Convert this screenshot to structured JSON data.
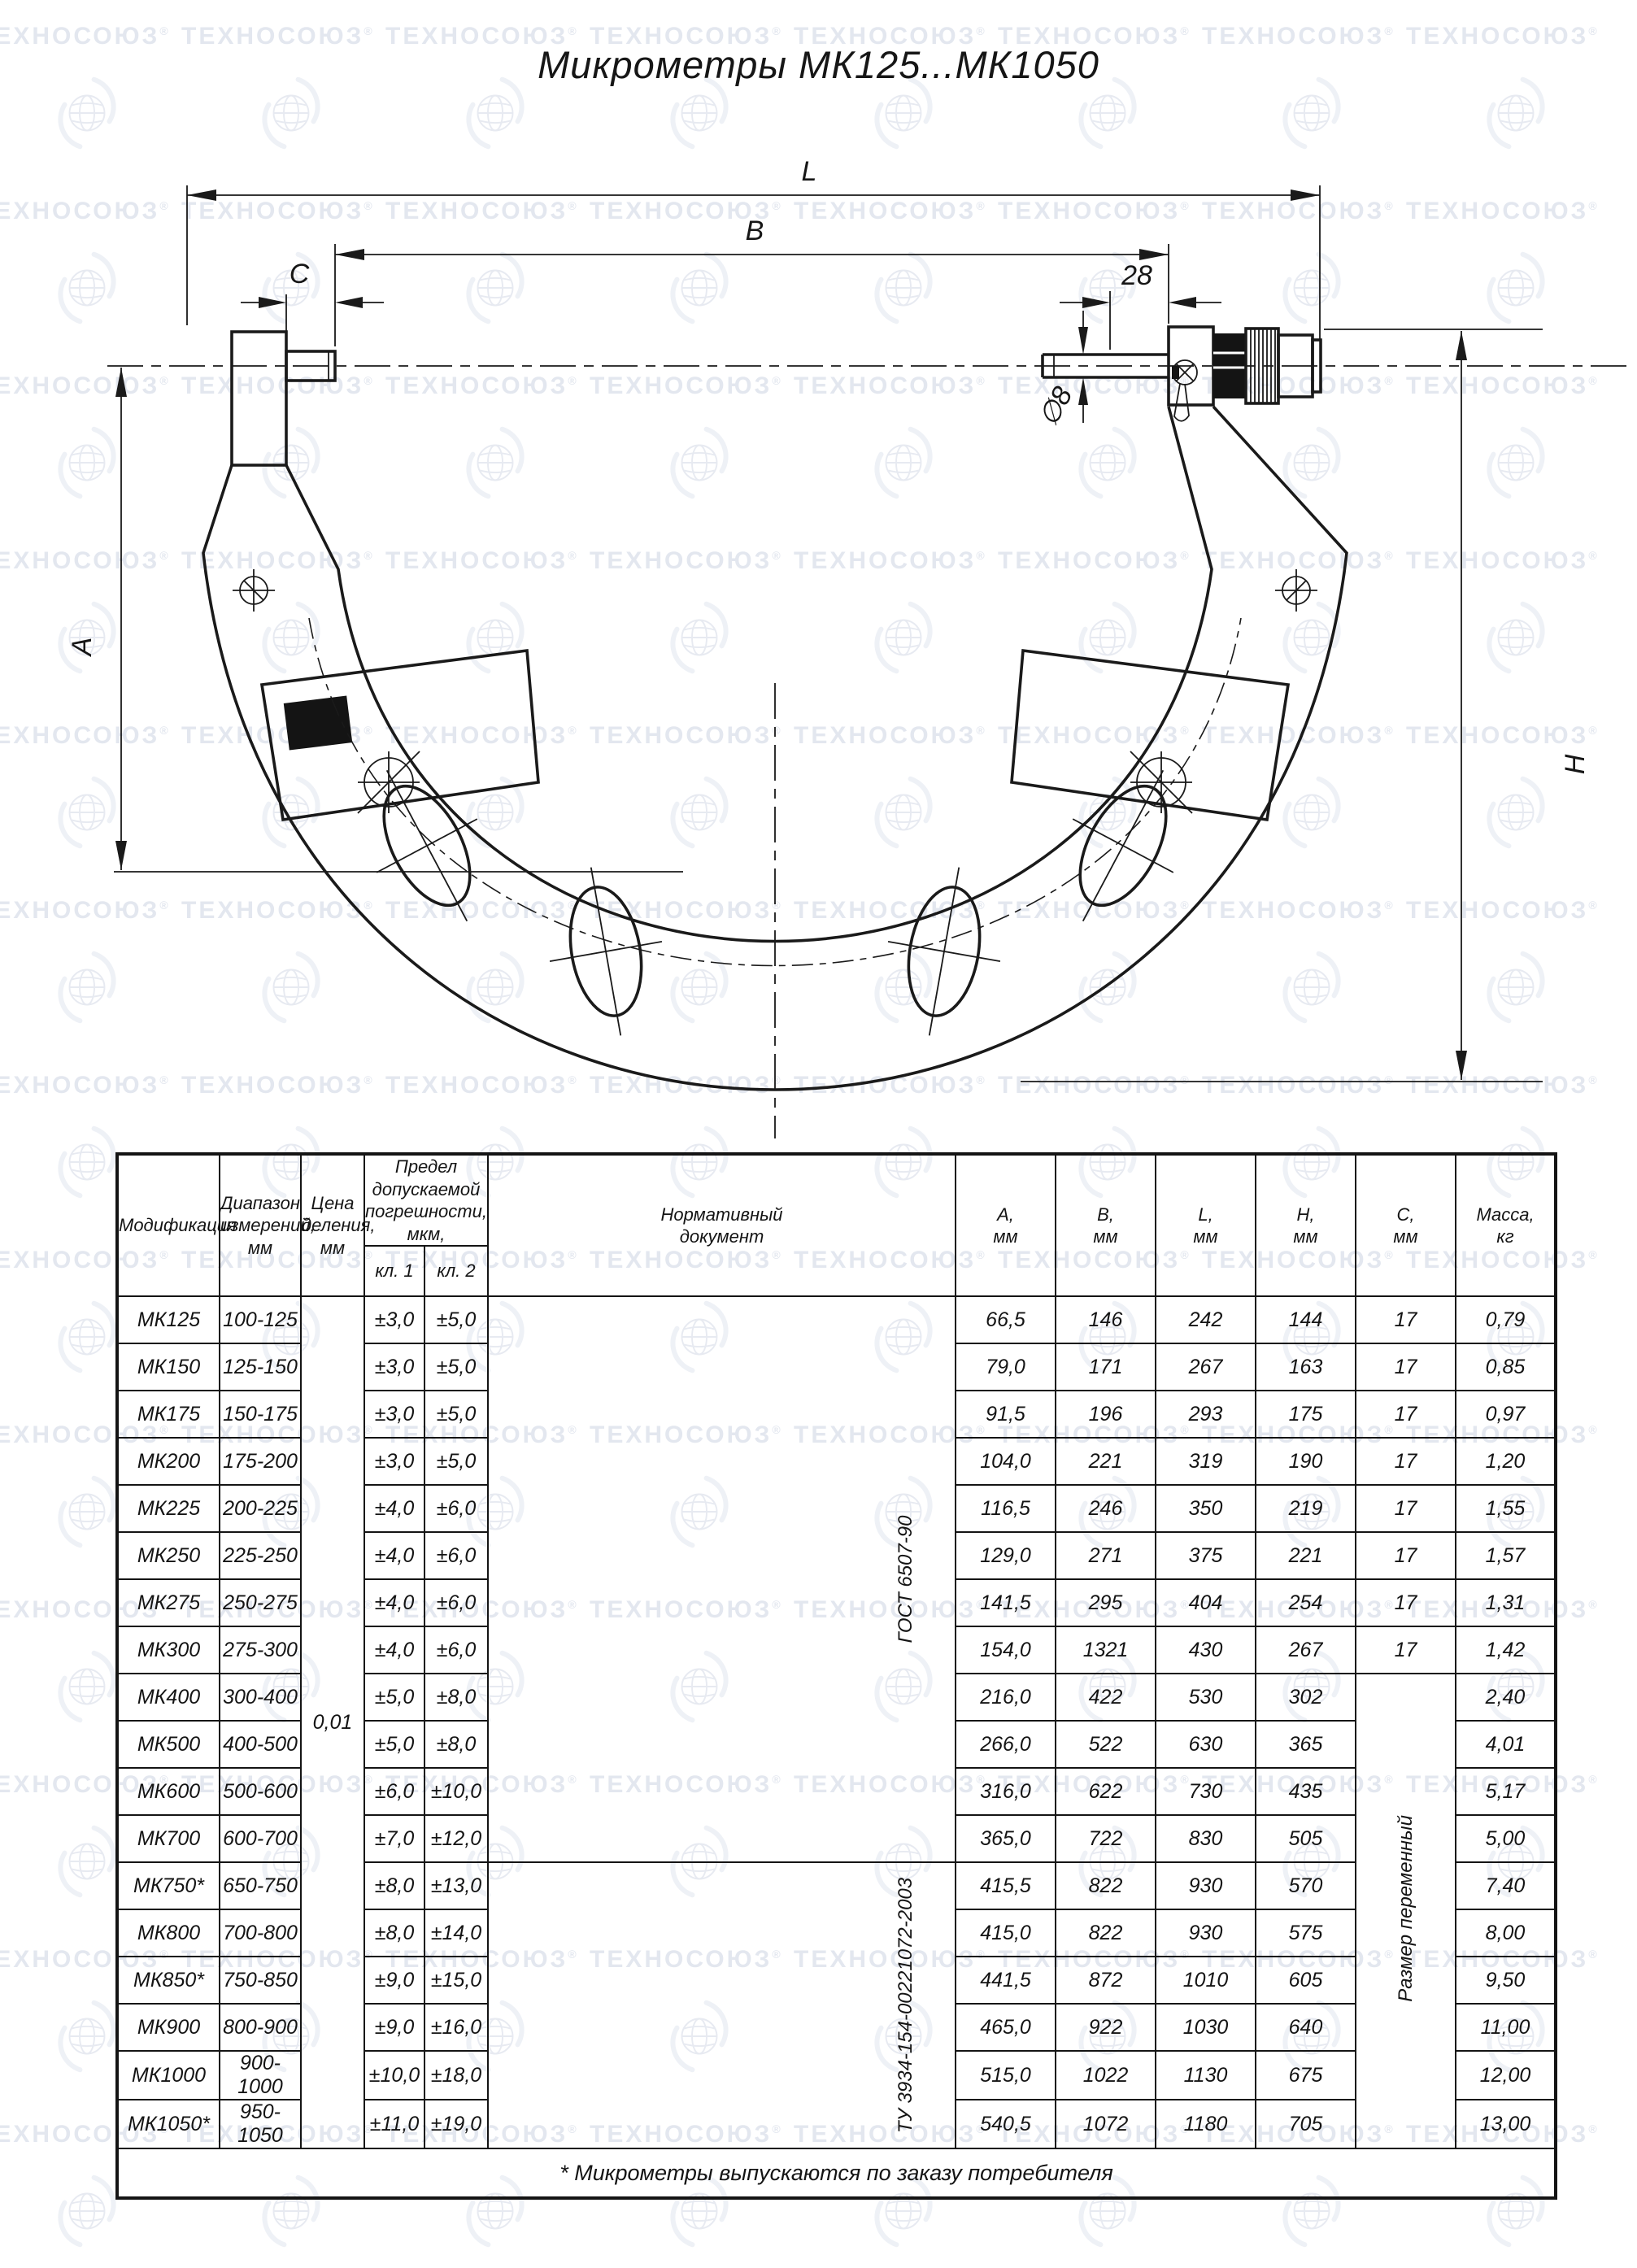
{
  "watermark": {
    "text": "ТЕХНОСОЮЗ",
    "reg": "®"
  },
  "title": "Микрометры МК125...МК1050",
  "drawing": {
    "dims": {
      "L": "L",
      "B": "B",
      "C": "C",
      "spindle_len": "28",
      "A": "A",
      "H": "H",
      "spindle_dia": "∅8"
    }
  },
  "table": {
    "headers": {
      "modification": "Модификация",
      "range": "Диапазон\nизмерений,\nмм",
      "division": "Цена\nделения,\nмм",
      "error_limit": "Предел допускаемой\nпогрешности, мкм,",
      "cl1": "кл. 1",
      "cl2": "кл. 2",
      "norm_doc": "Нормативный\nдокумент",
      "a": "А,\nмм",
      "b": "В,\nмм",
      "l": "L,\nмм",
      "h": "Н,\nмм",
      "c": "С,\nмм",
      "mass": "Масса,\nкг"
    },
    "merged": {
      "division_value": "0,01",
      "gost": "ГОСТ 6507-90",
      "tu": "ТУ 3934-154-00221072-2003",
      "c_note": "Размер переменный"
    },
    "rows": [
      {
        "model": "МК125",
        "range": "100-125",
        "cl1": "±3,0",
        "cl2": "±5,0",
        "a": "66,5",
        "b": "146",
        "l": "242",
        "h": "144",
        "c": "17",
        "mass": "0,79"
      },
      {
        "model": "МК150",
        "range": "125-150",
        "cl1": "±3,0",
        "cl2": "±5,0",
        "a": "79,0",
        "b": "171",
        "l": "267",
        "h": "163",
        "c": "17",
        "mass": "0,85"
      },
      {
        "model": "МК175",
        "range": "150-175",
        "cl1": "±3,0",
        "cl2": "±5,0",
        "a": "91,5",
        "b": "196",
        "l": "293",
        "h": "175",
        "c": "17",
        "mass": "0,97"
      },
      {
        "model": "МК200",
        "range": "175-200",
        "cl1": "±3,0",
        "cl2": "±5,0",
        "a": "104,0",
        "b": "221",
        "l": "319",
        "h": "190",
        "c": "17",
        "mass": "1,20"
      },
      {
        "model": "МК225",
        "range": "200-225",
        "cl1": "±4,0",
        "cl2": "±6,0",
        "a": "116,5",
        "b": "246",
        "l": "350",
        "h": "219",
        "c": "17",
        "mass": "1,55"
      },
      {
        "model": "МК250",
        "range": "225-250",
        "cl1": "±4,0",
        "cl2": "±6,0",
        "a": "129,0",
        "b": "271",
        "l": "375",
        "h": "221",
        "c": "17",
        "mass": "1,57"
      },
      {
        "model": "МК275",
        "range": "250-275",
        "cl1": "±4,0",
        "cl2": "±6,0",
        "a": "141,5",
        "b": "295",
        "l": "404",
        "h": "254",
        "c": "17",
        "mass": "1,31"
      },
      {
        "model": "МК300",
        "range": "275-300",
        "cl1": "±4,0",
        "cl2": "±6,0",
        "a": "154,0",
        "b": "1321",
        "l": "430",
        "h": "267",
        "c": "17",
        "mass": "1,42"
      },
      {
        "model": "МК400",
        "range": "300-400",
        "cl1": "±5,0",
        "cl2": "±8,0",
        "a": "216,0",
        "b": "422",
        "l": "530",
        "h": "302",
        "c": "",
        "mass": "2,40"
      },
      {
        "model": "МК500",
        "range": "400-500",
        "cl1": "±5,0",
        "cl2": "±8,0",
        "a": "266,0",
        "b": "522",
        "l": "630",
        "h": "365",
        "c": "",
        "mass": "4,01"
      },
      {
        "model": "МК600",
        "range": "500-600",
        "cl1": "±6,0",
        "cl2": "±10,0",
        "a": "316,0",
        "b": "622",
        "l": "730",
        "h": "435",
        "c": "",
        "mass": "5,17"
      },
      {
        "model": "МК700",
        "range": "600-700",
        "cl1": "±7,0",
        "cl2": "±12,0",
        "a": "365,0",
        "b": "722",
        "l": "830",
        "h": "505",
        "c": "",
        "mass": "5,00"
      },
      {
        "model": "МК750*",
        "range": "650-750",
        "cl1": "±8,0",
        "cl2": "±13,0",
        "a": "415,5",
        "b": "822",
        "l": "930",
        "h": "570",
        "c": "",
        "mass": "7,40"
      },
      {
        "model": "МК800",
        "range": "700-800",
        "cl1": "±8,0",
        "cl2": "±14,0",
        "a": "415,0",
        "b": "822",
        "l": "930",
        "h": "575",
        "c": "",
        "mass": "8,00"
      },
      {
        "model": "МК850*",
        "range": "750-850",
        "cl1": "±9,0",
        "cl2": "±15,0",
        "a": "441,5",
        "b": "872",
        "l": "1010",
        "h": "605",
        "c": "",
        "mass": "9,50"
      },
      {
        "model": "МК900",
        "range": "800-900",
        "cl1": "±9,0",
        "cl2": "±16,0",
        "a": "465,0",
        "b": "922",
        "l": "1030",
        "h": "640",
        "c": "",
        "mass": "11,00"
      },
      {
        "model": "МК1000",
        "range": "900-1000",
        "cl1": "±10,0",
        "cl2": "±18,0",
        "a": "515,0",
        "b": "1022",
        "l": "1130",
        "h": "675",
        "c": "",
        "mass": "12,00"
      },
      {
        "model": "МК1050*",
        "range": "950-1050",
        "cl1": "±11,0",
        "cl2": "±19,0",
        "a": "540,5",
        "b": "1072",
        "l": "1180",
        "h": "705",
        "c": "",
        "mass": "13,00"
      }
    ],
    "footnote": "* Микрометры выпускаются по заказу потребителя"
  }
}
